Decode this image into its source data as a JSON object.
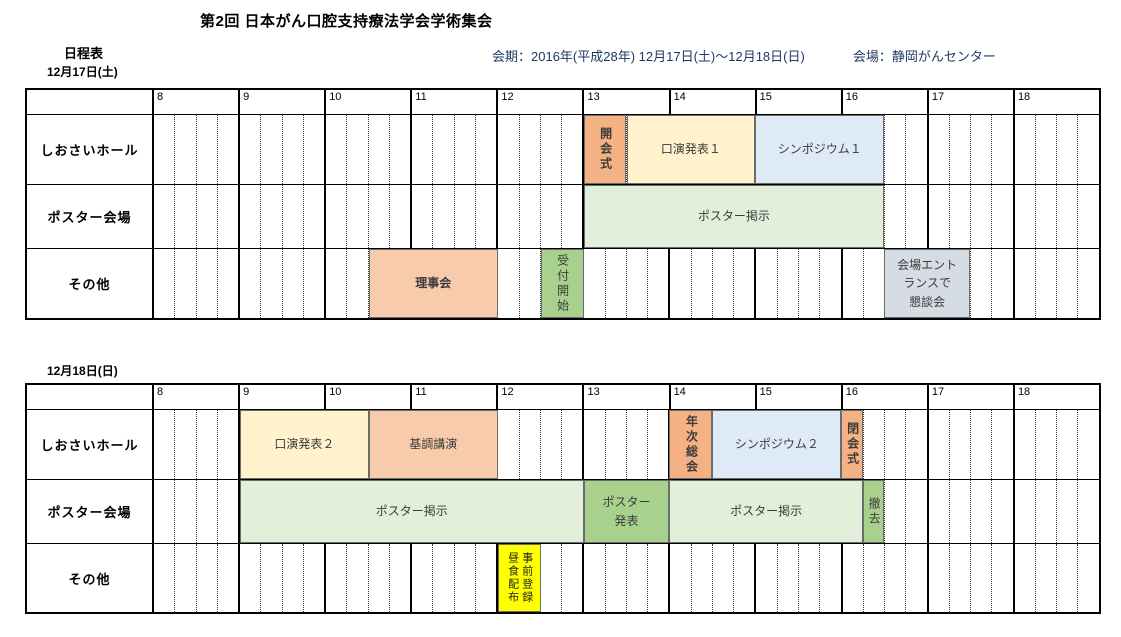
{
  "header": {
    "title": "第2回 日本がん口腔支持療法学会学術集会",
    "schedule_label": "日程表",
    "period": "会期：2016年(平成28年) 12月17日(土)～12月18日(日)",
    "venue": "会場：静岡がんセンター"
  },
  "colors": {
    "salmon": "#F4B183",
    "peach": "#F8CBAD",
    "cream": "#FFF2CC",
    "light_blue": "#DEEBF7",
    "light_green": "#E2EFDA",
    "green": "#A9D18E",
    "blue_gray": "#D6DCE4",
    "yellow": "#FFFF00",
    "info_text": "#1F3864",
    "grid_line": "#000000"
  },
  "timeline": {
    "start_hour": 8,
    "end_hour": 19,
    "hour_labels": [
      "8",
      "9",
      "10",
      "11",
      "12",
      "13",
      "14",
      "15",
      "16",
      "17",
      "18"
    ],
    "quarters_per_hour": 4
  },
  "tables": [
    {
      "date_label": "12月17日(土)",
      "rows": [
        {
          "label": "しおさいホール",
          "events": [
            {
              "name": "opening-ceremony",
              "label": "開会式",
              "start": 13,
              "end": 13.5,
              "color": "salmon",
              "orientation": "vertical",
              "bold": true
            },
            {
              "name": "oral-presentation-1",
              "label": "口演発表１",
              "start": 13.5,
              "end": 15,
              "color": "cream"
            },
            {
              "name": "symposium-1",
              "label": "シンポジウム１",
              "start": 15,
              "end": 16.5,
              "color": "light_blue"
            }
          ]
        },
        {
          "label": "ポスター会場",
          "events": [
            {
              "name": "poster-display-day1",
              "label": "ポスター掲示",
              "start": 13,
              "end": 16.5,
              "color": "light_green"
            }
          ]
        },
        {
          "label": "その他",
          "events": [
            {
              "name": "board-meeting",
              "label": "理事会",
              "start": 10.5,
              "end": 12,
              "color": "peach",
              "bold": true
            },
            {
              "name": "reception-open",
              "label": "受付開始",
              "start": 12.5,
              "end": 13,
              "color": "green",
              "orientation": "vertical"
            },
            {
              "name": "entrance-social-gathering",
              "label": "会場エントランスで懇談会",
              "lines": [
                "会場エント",
                "ランスで",
                "懇談会"
              ],
              "start": 16.5,
              "end": 17.5,
              "color": "blue_gray"
            }
          ]
        }
      ]
    },
    {
      "date_label": "12月18日(日)",
      "rows": [
        {
          "label": "しおさいホール",
          "events": [
            {
              "name": "oral-presentation-2",
              "label": "口演発表２",
              "start": 9,
              "end": 10.5,
              "color": "cream"
            },
            {
              "name": "keynote-lecture",
              "label": "基調講演",
              "start": 10.5,
              "end": 12,
              "color": "peach"
            },
            {
              "name": "annual-general-meeting",
              "label": "年次総会",
              "start": 14,
              "end": 14.5,
              "color": "salmon",
              "orientation": "vertical",
              "bold": true
            },
            {
              "name": "symposium-2",
              "label": "シンポジウム２",
              "start": 14.5,
              "end": 16,
              "color": "light_blue"
            },
            {
              "name": "closing-ceremony",
              "label": "閉会式",
              "start": 16,
              "end": 16.25,
              "color": "salmon",
              "orientation": "vertical",
              "bold": true
            }
          ]
        },
        {
          "label": "ポスター会場",
          "events": [
            {
              "name": "poster-display-day2-morning",
              "label": "ポスター掲示",
              "start": 9,
              "end": 13,
              "color": "light_green"
            },
            {
              "name": "poster-presentation",
              "label": "ポスター発表",
              "lines": [
                "ポスター",
                "発表"
              ],
              "start": 13,
              "end": 14,
              "color": "green"
            },
            {
              "name": "poster-display-day2-afternoon",
              "label": "ポスター掲示",
              "start": 14,
              "end": 16.25,
              "color": "light_green"
            },
            {
              "name": "poster-removal",
              "label": "撤去",
              "start": 16.25,
              "end": 16.5,
              "color": "green",
              "orientation": "vertical"
            }
          ]
        },
        {
          "label": "その他",
          "events": [
            {
              "name": "lunch-distribution-preregistration",
              "label": "昼食配布・事前登録",
              "columns": [
                "昼食配布",
                "事前登録"
              ],
              "start": 12,
              "end": 12.5,
              "color": "yellow"
            }
          ]
        }
      ]
    }
  ]
}
